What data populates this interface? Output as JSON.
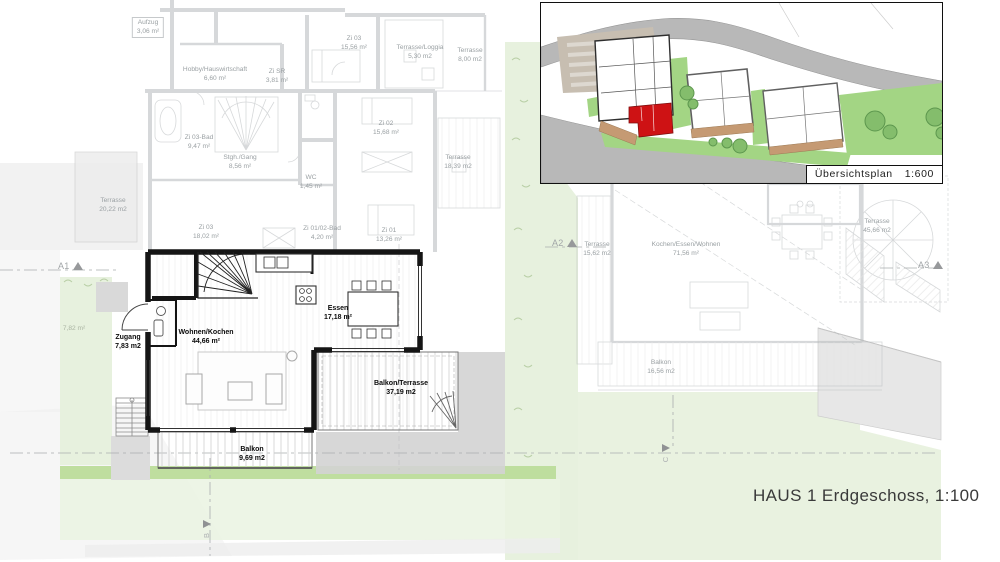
{
  "sheet": {
    "title": "HAUS 1 Erdgeschoss, 1:100"
  },
  "inset": {
    "caption": "Übersichtsplan",
    "scale": "1:600"
  },
  "section_markers": {
    "a1": "A1",
    "a2": "A2",
    "a3": "A3",
    "b": "B",
    "c": "C"
  },
  "rooms": {
    "aufzug": {
      "name": "Aufzug",
      "area": "3,06 m²"
    },
    "hobby": {
      "name": "Hobby/Hauswirtschaft",
      "area": "6,60 m²"
    },
    "zi_sr": {
      "name": "Zi SR",
      "area": "3,81 m²"
    },
    "zi03_og": {
      "name": "Zi 03",
      "area": "15,56 m²"
    },
    "terrasse_loggia": {
      "name": "Terrasse/Loggia",
      "area": "5,30 m2"
    },
    "terrasse_800": {
      "name": "Terrasse",
      "area": "8,00 m2"
    },
    "zi03_bad": {
      "name": "Zi 03-Bad",
      "area": "9,47 m²"
    },
    "stgh_gang": {
      "name": "Stgh./Gang",
      "area": "8,56 m²"
    },
    "wc": {
      "name": "WC",
      "area": "1,45 m²"
    },
    "zi02": {
      "name": "Zi 02",
      "area": "15,68 m²"
    },
    "terrasse_1839": {
      "name": "Terrasse",
      "area": "18,39 m2"
    },
    "terrasse_2022": {
      "name": "Terrasse",
      "area": "20,22 m2"
    },
    "zi03_eg": {
      "name": "Zi 03",
      "area": "18,02 m²"
    },
    "zi0102_bad": {
      "name": "Zi 01/02-Bad",
      "area": "4,20 m²"
    },
    "zi01": {
      "name": "Zi 01",
      "area": "13,26 m²"
    },
    "garden_782": {
      "area": "7,82 m²"
    },
    "terrasse_1562": {
      "name": "Terrasse",
      "area": "15,62 m2"
    },
    "kochen_essen_wohnen": {
      "name": "Kochen/Essen/Wohnen",
      "area": "71,56 m²"
    },
    "terrasse_4566": {
      "name": "Terrasse",
      "area": "45,66 m2"
    },
    "balkon_1656": {
      "name": "Balkon",
      "area": "16,56 m2"
    },
    "zugang": {
      "name": "Zugang",
      "area": "7,83 m2"
    },
    "wohnen_kochen": {
      "name": "Wohnen/Kochen",
      "area": "44,66 m²"
    },
    "essen": {
      "name": "Essen",
      "area": "17,18 m²"
    },
    "balkon_terrasse": {
      "name": "Balkon/Terrasse",
      "area": "37,19 m2"
    },
    "balkon_969": {
      "name": "Balkon",
      "area": "9,69 m2"
    }
  },
  "colors": {
    "highlight_unit_red": "#ce1214",
    "wall_black": "#151515",
    "ghost_gray": "#b6babc",
    "lawn_light": "#e7f1de",
    "lawn_strip": "#bcdc9a",
    "inset_lawn": "#a3d584",
    "road_gray": "#b8b8b8",
    "terrace_tan": "#c59a73",
    "parking_beige": "#c7beb1"
  }
}
